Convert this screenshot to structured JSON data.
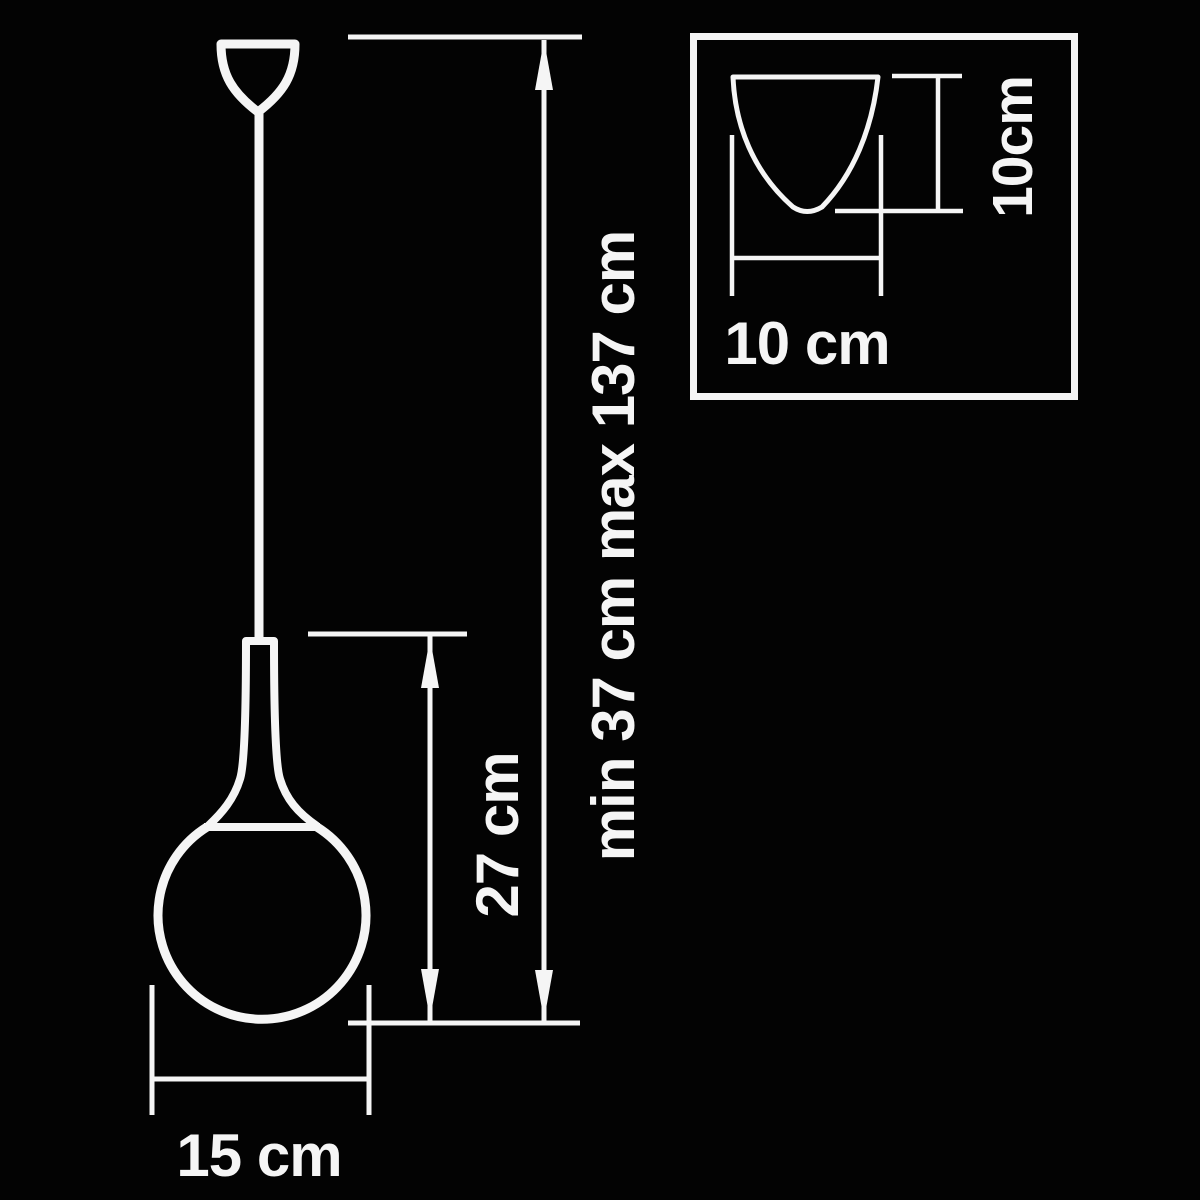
{
  "colors": {
    "background": "#030303",
    "line": "#f5f5f5"
  },
  "main_view": {
    "width_label": "15 cm",
    "body_height_label": "27 cm",
    "suspension_height_label": "min 37 cm max 137 cm"
  },
  "inset_view": {
    "shade_width_label": "10 cm",
    "shade_height_label": "10cm"
  }
}
